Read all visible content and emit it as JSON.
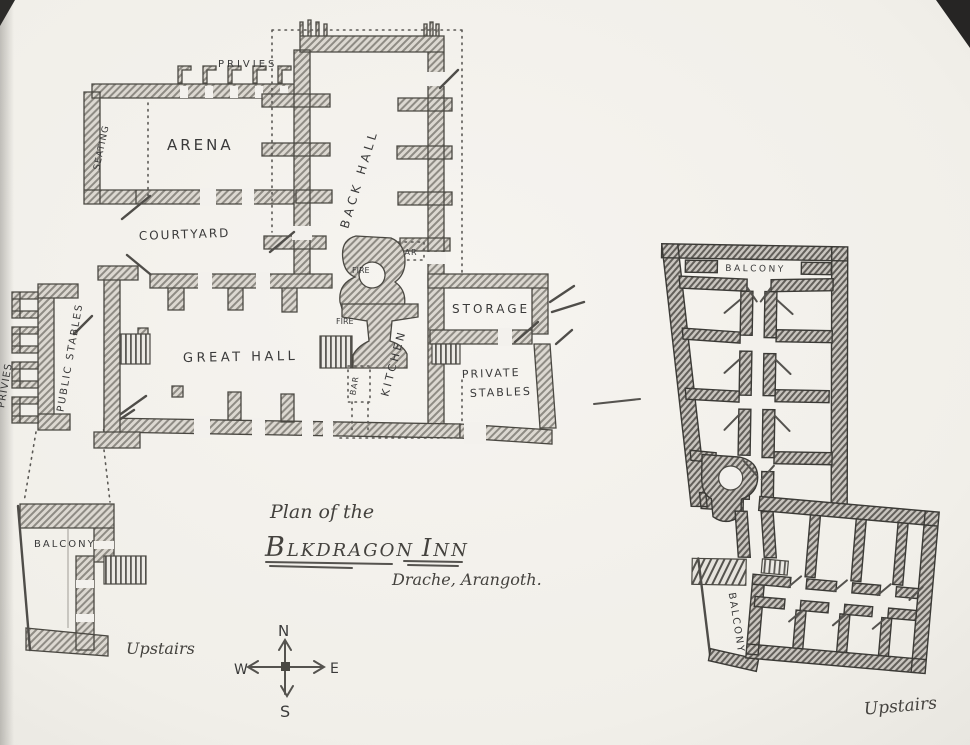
{
  "colors": {
    "paper": "#f2f0ec",
    "ink": "#3a3a3a"
  },
  "title": {
    "prefix": "Plan of the",
    "name_b": "B",
    "name_rest": "LKDRAGON",
    "name_i": "I",
    "name_inn_rest": "NN",
    "location": "Drache, Arangoth."
  },
  "compass": {
    "north": "N",
    "east": "E",
    "south": "S",
    "west": "W"
  },
  "ground_floor": {
    "privies_north": "PRIVIES",
    "seating": "SEATING",
    "arena": "ARENA",
    "back_hall": "BACK HALL",
    "courtyard": "COURTYARD",
    "bar_north": "BAR",
    "fire_north": "FIRE",
    "fire_south": "FIRE",
    "bar_south": "BAR",
    "storage": "STORAGE",
    "great_hall": "GREAT HALL",
    "kitchen": "KITCHEN",
    "private_stables_1": "PRIVATE",
    "private_stables_2": "STABLES",
    "public_stables": "PUBLIC STABLES",
    "privies_west": "PRIVIES"
  },
  "stables_upstairs": {
    "balcony": "BALCONY",
    "caption": "Upstairs"
  },
  "inn_upstairs": {
    "balcony_north": "BALCONY",
    "balcony_west": "BALCONY",
    "caption": "Upstairs"
  }
}
